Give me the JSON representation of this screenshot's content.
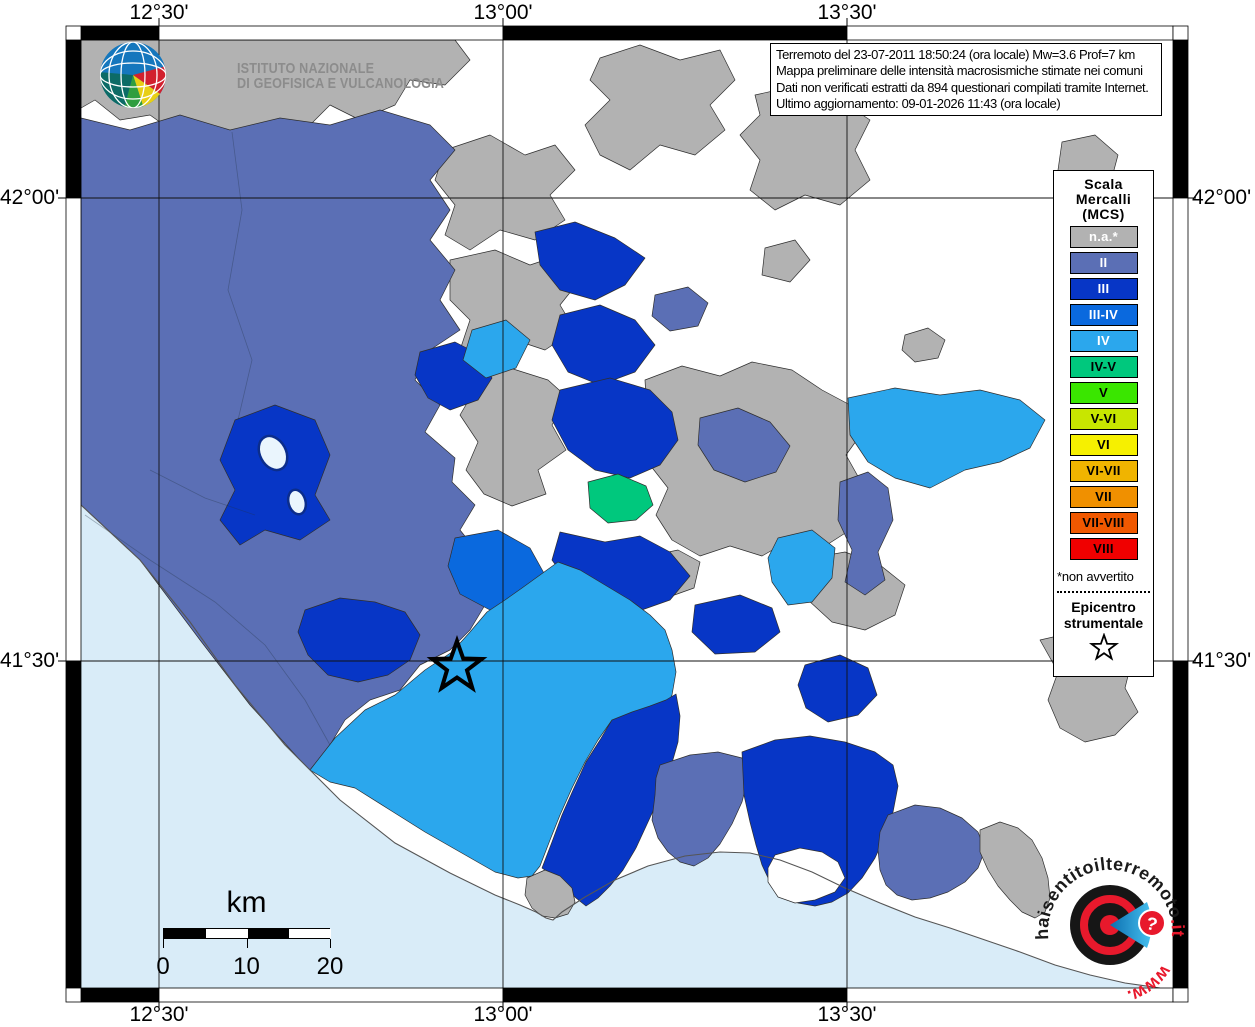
{
  "header": {
    "ingv_line1": "ISTITUTO NAZIONALE",
    "ingv_line2": "DI GEOFISICA E VULCANOLOGIA"
  },
  "info_box": {
    "lines": [
      "Terremoto del 23-07-2011 18:50:24 (ora locale) Mw=3.6 Prof=7 km",
      "Mappa preliminare delle intensità macrosismiche stimate nei comuni",
      "Dati non verificati estratti da 894 questionari compilati tramite Internet.",
      "Ultimo aggiornamento: 09-01-2026 11:43 (ora locale)"
    ]
  },
  "axes": {
    "top": [
      {
        "label": "12°30'",
        "x": 159
      },
      {
        "label": "13°00'",
        "x": 503
      },
      {
        "label": "13°30'",
        "x": 847
      }
    ],
    "bottom": [
      {
        "label": "12°30'",
        "x": 159
      },
      {
        "label": "13°00'",
        "x": 503
      },
      {
        "label": "13°30'",
        "x": 847
      }
    ],
    "left": [
      {
        "label": "42°00'",
        "y": 198
      },
      {
        "label": "41°30'",
        "y": 661
      }
    ],
    "right": [
      {
        "label": "42°00'",
        "y": 198
      },
      {
        "label": "41°30'",
        "y": 661
      }
    ]
  },
  "legend": {
    "title_lines": [
      "Scala",
      "Mercalli",
      "(MCS)"
    ],
    "items": [
      {
        "label": "n.a.*",
        "key": "na",
        "text": "#ffffff"
      },
      {
        "label": "II",
        "key": "II",
        "text": "#ffffff"
      },
      {
        "label": "III",
        "key": "III",
        "text": "#ffffff"
      },
      {
        "label": "III-IV",
        "key": "III-IV",
        "text": "#ffffff"
      },
      {
        "label": "IV",
        "key": "IV",
        "text": "#ffffff"
      },
      {
        "label": "IV-V",
        "key": "IV-V",
        "text": "#000000"
      },
      {
        "label": "V",
        "key": "V",
        "text": "#000000"
      },
      {
        "label": "V-VI",
        "key": "V-VI",
        "text": "#000000"
      },
      {
        "label": "VI",
        "key": "VI",
        "text": "#000000"
      },
      {
        "label": "VI-VII",
        "key": "VI-VII",
        "text": "#000000"
      },
      {
        "label": "VII",
        "key": "VII",
        "text": "#000000"
      },
      {
        "label": "VII-VIII",
        "key": "VII-VIII",
        "text": "#000000"
      },
      {
        "label": "VIII",
        "key": "VIII",
        "text": "#000000"
      }
    ],
    "footnote": "*non avvertito",
    "epicenter_lines": [
      "Epicentro",
      "strumentale"
    ]
  },
  "scalebar": {
    "unit": "km",
    "labels": [
      "0",
      "10",
      "20"
    ],
    "length": 167
  },
  "watermark": {
    "main": "haisentitoilterremoto",
    "suffix": ".it",
    "www": "www.",
    "question": "?"
  },
  "epicenter": {
    "x": 457,
    "y": 667
  },
  "colors": {
    "na": "#b2b2b2",
    "II": "#5b6fb5",
    "III": "#0736c6",
    "III-IV": "#0a69de",
    "IV": "#2ba7ed",
    "IV-V": "#00c87d",
    "V": "#3ae600",
    "V-VI": "#c8e600",
    "VI": "#f6f000",
    "VI-VII": "#f0b400",
    "VII": "#f09000",
    "VII-VIII": "#f05800",
    "VIII": "#f00000",
    "white": "#ffffff",
    "sea": "#d9ecf8",
    "land": "#ffffff"
  },
  "map": {
    "frame": {
      "grid_x": [
        159,
        503,
        847
      ],
      "grid_y": [
        198,
        661
      ]
    },
    "coast_points": "81,505 140,560 190,622 235,685 285,745 340,800 395,843 450,873 495,895 520,905 536,912 546,918 553,920 562,912 585,897 615,880 648,866 685,856 720,852 750,853 780,860 812,872 845,888 880,903 915,917 950,928 985,940 1020,952 1055,965 1090,975 1125,983 1160,988",
    "boundaries": [
      "85,515 150,560 215,602 265,645 305,700 330,745",
      "232,132 242,210 228,290 252,360 238,420",
      "150,470 205,498 255,515"
    ],
    "lakes": [
      {
        "cx": 273,
        "cy": 453,
        "rx": 13,
        "ry": 18,
        "rot": -28
      },
      {
        "cx": 297,
        "cy": 502,
        "rx": 8.5,
        "ry": 12.5,
        "rot": -15
      }
    ],
    "regions": [
      {
        "i": "na",
        "pts": "81,40 455,40 470,60 445,85 410,80 395,105 360,120 330,105 300,135 270,150 245,130 215,150 185,140 150,115 120,120 95,100 81,108"
      },
      {
        "i": "na",
        "pts": "445,150 490,135 525,155 555,145 575,170 550,195 565,220 535,240 500,230 470,250 445,235 455,205 435,180"
      },
      {
        "i": "na",
        "pts": "450,260 495,250 530,265 560,255 580,280 560,305 575,330 545,350 515,340 490,360 460,350 470,320 450,300"
      },
      {
        "i": "na",
        "pts": "468,380 510,368 548,380 568,398 552,425 566,450 538,470 546,494 512,506 484,494 466,470 478,442 460,415 470,398"
      },
      {
        "i": "na",
        "pts": "600,58 640,45 680,60 720,50 735,80 710,105 725,130 695,155 660,145 630,170 600,155 585,125 610,100 590,80"
      },
      {
        "i": "na",
        "pts": "755,95 800,85 840,100 870,120 855,150 870,180 840,205 805,195 775,210 750,190 760,160 740,135 760,115"
      },
      {
        "i": "na",
        "pts": "765,248 795,240 810,260 790,282 762,275"
      },
      {
        "i": "na",
        "pts": "1062,142 1095,135 1118,155 1110,185 1122,210 1098,232 1068,222 1075,195 1058,170"
      },
      {
        "i": "na",
        "pts": "905,335 928,328 945,340 938,358 915,362 902,350"
      },
      {
        "i": "II",
        "pts": "81,118 130,130 180,115 230,130 280,118 330,125 380,110 430,125 455,150 430,180 450,210 430,240 455,270 440,300 460,330 430,350 415,380 440,405 425,432 455,458 452,482 475,505 460,530 480,555 465,580 485,605 470,630 450,650 420,665 400,690 370,700 345,720 330,745 310,770 300,760 250,705 200,640 140,560 81,505"
      },
      {
        "i": "na",
        "pts": "645,380 682,366 720,376 752,362 792,370 822,390 852,406 864,430 846,455 860,480 840,505 850,530 822,548 790,540 762,556 730,546 700,556 672,540 656,515 668,488 650,465 664,440 647,415"
      },
      {
        "i": "na",
        "pts": "640,558 678,550 700,562 694,588 666,598 644,588"
      },
      {
        "i": "na",
        "pts": "800,560 845,552 880,565 905,585 895,615 865,630 832,622 808,600"
      },
      {
        "i": "III",
        "pts": "235,420 275,405 315,420 330,455 315,495 330,520 300,540 265,530 240,545 220,520 235,490 220,460"
      },
      {
        "i": "III",
        "pts": "535,232 575,222 615,238 645,258 625,285 595,300 560,290 540,265"
      },
      {
        "i": "III",
        "pts": "420,352 455,342 480,355 492,378 478,400 450,410 428,398 415,375"
      },
      {
        "i": "IV",
        "pts": "472,330 506,320 530,340 516,368 486,378 463,360"
      },
      {
        "i": "III",
        "pts": "560,315 600,305 635,320 655,345 635,372 600,385 568,372 552,345"
      },
      {
        "i": "III",
        "pts": "560,390 610,378 650,390 672,412 678,440 660,465 630,478 595,470 568,450 552,420"
      },
      {
        "i": "II",
        "pts": "655,295 688,287 708,303 698,326 670,331 652,316"
      },
      {
        "i": "II",
        "pts": "700,418 738,408 770,422 790,446 776,472 745,482 714,470 698,445"
      },
      {
        "i": "II",
        "pts": "840,482 868,472 888,488 893,520 878,552 885,580 865,595 845,582 852,550 838,520"
      },
      {
        "i": "IV",
        "pts": "848,398 895,388 940,395 980,390 1020,400 1045,420 1030,448 1000,462 965,470 930,488 895,478 868,462 850,435"
      },
      {
        "i": "IV",
        "pts": "778,538 812,530 835,548 832,578 812,602 788,605 772,582 768,558"
      },
      {
        "i": "IV-V",
        "pts": "588,482 618,474 646,486 653,505 636,520 608,523 590,508"
      },
      {
        "i": "III",
        "pts": "560,532 605,542 640,536 670,552 690,576 670,600 636,612 600,600 570,585 552,560"
      },
      {
        "i": "III-IV",
        "pts": "455,538 498,530 530,548 545,575 525,602 490,610 460,594 448,566"
      },
      {
        "i": "III",
        "pts": "695,605 740,595 772,608 780,632 755,652 715,654 692,632"
      },
      {
        "i": "IV",
        "pts": "310,770 335,738 365,710 395,695 425,670 452,652 470,632 487,612 505,600 522,588 540,575 558,562 580,570 605,585 630,600 650,615 665,630 672,650 676,672 672,695 662,715 648,728 630,724 612,720 598,740 585,762 572,788 560,815 550,840 540,866 532,876 518,878 495,872 460,852 425,832 390,810 355,788 330,782"
      },
      {
        "i": "III",
        "pts": "612,720 632,712 650,706 666,700 676,694 680,716 678,742 670,770 660,796 648,822 636,848 623,870 610,886 598,898 586,906 576,898 566,888 556,878 542,868 552,842 562,815 574,788 586,762 600,740"
      },
      {
        "i": "II",
        "pts": "660,765 690,755 718,752 742,758 748,778 742,802 732,824 720,844 708,858 694,866 680,862 668,852 658,838 652,820 655,795 656,778"
      },
      {
        "i": "III",
        "pts": "742,752 775,740 810,736 845,742 875,752 893,765 898,786 893,812 885,836 875,858 862,878 848,893 832,902 815,906 798,903 782,895 770,882 762,865 756,845 750,822 744,795"
      },
      {
        "i": "III",
        "pts": "305,610 340,598 375,602 405,612 420,635 410,660 388,675 358,682 328,675 308,655 298,632"
      },
      {
        "i": "III",
        "pts": "805,665 840,655 868,668 877,695 858,715 828,722 806,708 798,685"
      },
      {
        "i": "white",
        "pts": "775,855 800,848 822,852 838,862 845,878 835,892 815,900 795,903 778,897 768,882 768,868"
      },
      {
        "i": "II",
        "pts": "888,815 915,805 940,808 962,818 978,832 985,850 978,868 965,882 948,892 930,898 912,900 897,895 886,885 880,870 878,850 880,832"
      },
      {
        "i": "na",
        "pts": "980,830 1000,822 1018,828 1032,840 1042,858 1048,878 1050,898 1045,912 1035,918 1022,912 1010,900 998,886 988,870 980,852"
      },
      {
        "i": "na",
        "pts": "527,878 545,870 560,876 572,888 575,902 568,914 555,918 542,916 532,908 525,895"
      },
      {
        "i": "na",
        "pts": "1040,640 1075,632 1108,642 1132,660 1125,688 1138,712 1115,735 1085,742 1060,728 1048,700 1058,672"
      }
    ]
  }
}
